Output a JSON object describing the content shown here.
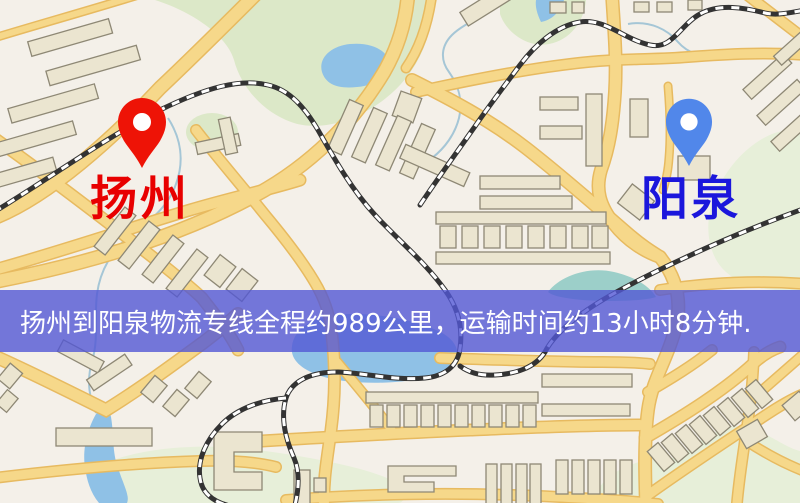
{
  "banner": {
    "text": "扬州到阳泉物流专线全程约989公里，运输时间约13小时8分钟."
  },
  "markers": {
    "origin": {
      "label": "扬州"
    },
    "destination": {
      "label": "阳泉"
    }
  },
  "colors": {
    "background": "#f4f0e9",
    "road": "#f6d88a",
    "road_casing": "#e7ba60",
    "water": "#8fc1e6",
    "teal_water": "#9ccfc9",
    "stream": "#a5c6d6",
    "park": "#dce8c8",
    "park_pale": "#e7efd9",
    "building": "#ebe5d0",
    "building_stroke": "#8e8875",
    "railway": "#333333",
    "rail_dash": "#ffffff",
    "banner": "#5358d4",
    "banner_text": "#ffffff",
    "origin_pin": "#ee1306",
    "origin_label": "#e80000",
    "destination_pin": "#5187ea",
    "destination_label": "#1b16dc",
    "pin_inner": "#ffffff"
  }
}
